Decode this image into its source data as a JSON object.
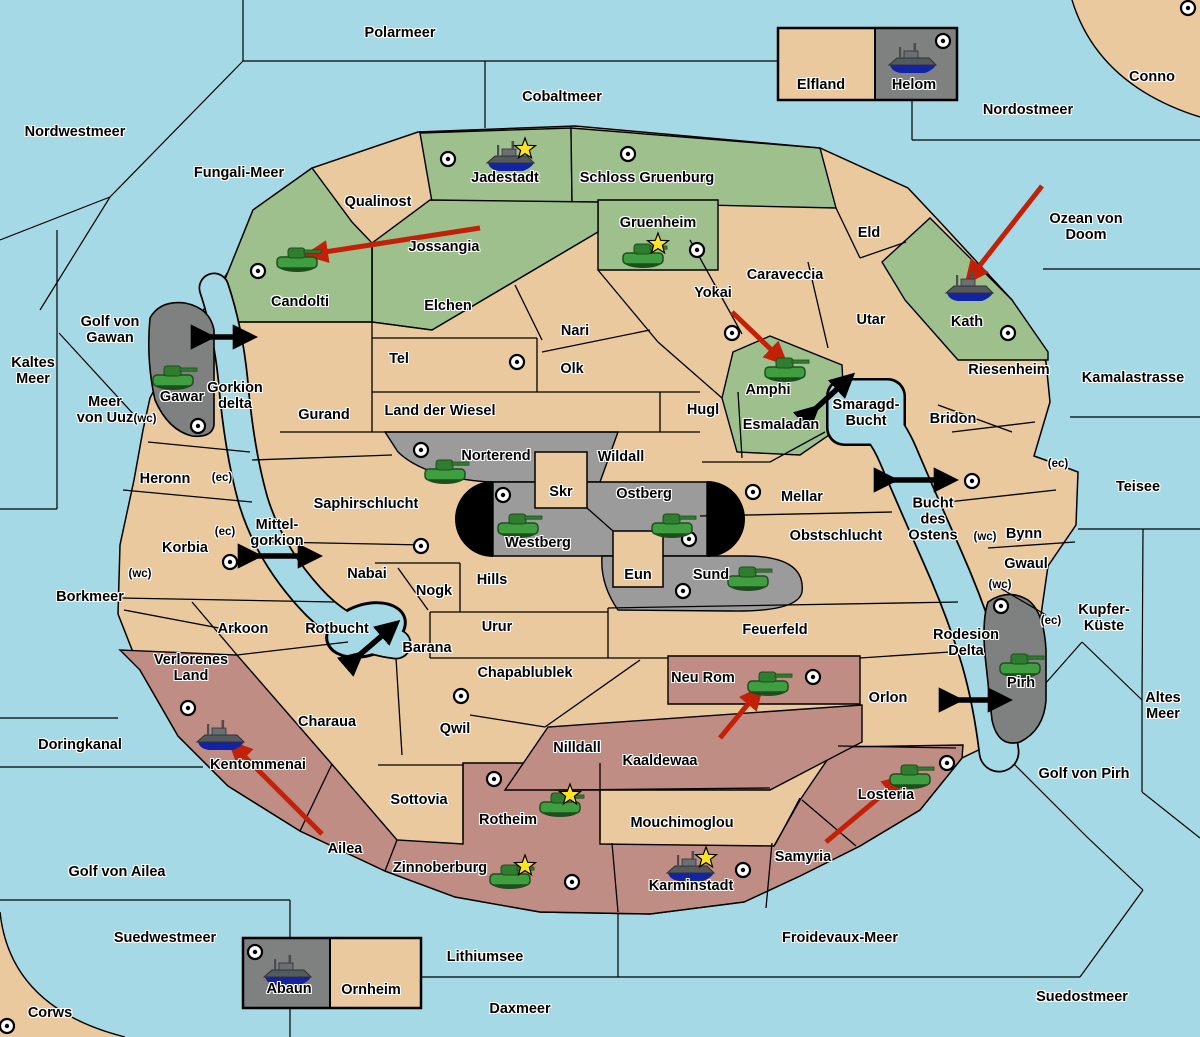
{
  "map": {
    "width": 1200,
    "height": 1037,
    "colors": {
      "sea": "#A6D9E6",
      "land": "#E9C99D",
      "green_faction": "#9DC08D",
      "red_faction": "#C08D85",
      "gray_light": "#9B9B9B",
      "gray_dark": "#7F8080",
      "black_feature": "#000000",
      "move_arrow": "#C22107",
      "strait_arrow": "#000000",
      "tank": "#3F9E3F",
      "ship": "#555A5E",
      "star": "#FFE41F",
      "border": "#000000"
    },
    "sea_zones": [
      {
        "name": "Polarmeer",
        "x": 400,
        "y": 33
      },
      {
        "name": "Nordwestmeer",
        "x": 75,
        "y": 132
      },
      {
        "name": "Fungali-Meer",
        "x": 239,
        "y": 173
      },
      {
        "name": "Cobaltmeer",
        "x": 562,
        "y": 97
      },
      {
        "name": "Nordostmeer",
        "x": 1028,
        "y": 110
      },
      {
        "name": "Ozean von Doom",
        "x": 1086,
        "y": 227
      },
      {
        "name": "Kaltes\nMeer",
        "x": 33,
        "y": 371
      },
      {
        "name": "Golf von\nGawan",
        "x": 110,
        "y": 330
      },
      {
        "name": "Meer\nvon Uuz",
        "x": 105,
        "y": 410
      },
      {
        "name": "Kamalastrasse",
        "x": 1133,
        "y": 378
      },
      {
        "name": "Teisee",
        "x": 1138,
        "y": 487
      },
      {
        "name": "Borkmeer",
        "x": 90,
        "y": 597
      },
      {
        "name": "Kupfer-\nKüste",
        "x": 1104,
        "y": 618
      },
      {
        "name": "Altes\nMeer",
        "x": 1163,
        "y": 706
      },
      {
        "name": "Doringkanal",
        "x": 80,
        "y": 745
      },
      {
        "name": "Golf von Pirh",
        "x": 1084,
        "y": 774
      },
      {
        "name": "Golf von Ailea",
        "x": 117,
        "y": 872
      },
      {
        "name": "Suedwestmeer",
        "x": 165,
        "y": 938
      },
      {
        "name": "Froidevaux-Meer",
        "x": 840,
        "y": 938
      },
      {
        "name": "Lithiumsee",
        "x": 485,
        "y": 957
      },
      {
        "name": "Daxmeer",
        "x": 520,
        "y": 1009
      },
      {
        "name": "Suedostmeer",
        "x": 1082,
        "y": 997
      },
      {
        "name": "Gorkion\ndelta",
        "x": 235,
        "y": 396
      },
      {
        "name": "Mittel-\ngorkion",
        "x": 277,
        "y": 533
      },
      {
        "name": "Rotbucht",
        "x": 337,
        "y": 629
      },
      {
        "name": "Smaragd-\nBucht",
        "x": 866,
        "y": 413
      },
      {
        "name": "Bucht\ndes\nOstens",
        "x": 933,
        "y": 520
      },
      {
        "name": "Rodesion\nDelta",
        "x": 966,
        "y": 643
      }
    ],
    "territories": [
      {
        "name": "Qualinost",
        "x": 378,
        "y": 202
      },
      {
        "name": "Jossangia",
        "x": 444,
        "y": 247
      },
      {
        "name": "Candolti",
        "x": 300,
        "y": 302
      },
      {
        "name": "Jadestadt",
        "x": 505,
        "y": 178
      },
      {
        "name": "Schloss Gruenburg",
        "x": 647,
        "y": 178
      },
      {
        "name": "Gruenheim",
        "x": 658,
        "y": 223
      },
      {
        "name": "Elfland",
        "x": 821,
        "y": 85
      },
      {
        "name": "Helom",
        "x": 914,
        "y": 85
      },
      {
        "name": "Conno",
        "x": 1152,
        "y": 77
      },
      {
        "name": "Eld",
        "x": 869,
        "y": 233
      },
      {
        "name": "Caraveccia",
        "x": 785,
        "y": 275
      },
      {
        "name": "Yokai",
        "x": 713,
        "y": 293
      },
      {
        "name": "Utar",
        "x": 871,
        "y": 320
      },
      {
        "name": "Kath",
        "x": 967,
        "y": 322
      },
      {
        "name": "Riesenheim",
        "x": 1009,
        "y": 370
      },
      {
        "name": "Bridon",
        "x": 953,
        "y": 419
      },
      {
        "name": "Elchen",
        "x": 448,
        "y": 306
      },
      {
        "name": "Nari",
        "x": 575,
        "y": 331
      },
      {
        "name": "Tel",
        "x": 399,
        "y": 359
      },
      {
        "name": "Olk",
        "x": 572,
        "y": 369
      },
      {
        "name": "Gurand",
        "x": 324,
        "y": 415
      },
      {
        "name": "Land der Wiesel",
        "x": 440,
        "y": 411
      },
      {
        "name": "Hugl",
        "x": 703,
        "y": 410
      },
      {
        "name": "Esmaladan",
        "x": 781,
        "y": 425
      },
      {
        "name": "Amphi",
        "x": 768,
        "y": 390
      },
      {
        "name": "Gawar",
        "x": 182,
        "y": 397
      },
      {
        "name": "Norterend",
        "x": 496,
        "y": 456
      },
      {
        "name": "Wildall",
        "x": 621,
        "y": 457
      },
      {
        "name": "Skr",
        "x": 561,
        "y": 492
      },
      {
        "name": "Ostberg",
        "x": 644,
        "y": 494
      },
      {
        "name": "Westberg",
        "x": 538,
        "y": 543
      },
      {
        "name": "Mellar",
        "x": 802,
        "y": 497
      },
      {
        "name": "Obstschlucht",
        "x": 836,
        "y": 536
      },
      {
        "name": "Bynn",
        "x": 1024,
        "y": 534
      },
      {
        "name": "Gwaul",
        "x": 1026,
        "y": 564
      },
      {
        "name": "Saphirschlucht",
        "x": 366,
        "y": 504
      },
      {
        "name": "Heronn",
        "x": 165,
        "y": 479
      },
      {
        "name": "Korbia",
        "x": 185,
        "y": 548
      },
      {
        "name": "Nabai",
        "x": 367,
        "y": 574
      },
      {
        "name": "Nogk",
        "x": 434,
        "y": 591
      },
      {
        "name": "Hills",
        "x": 492,
        "y": 580
      },
      {
        "name": "Eun",
        "x": 638,
        "y": 575
      },
      {
        "name": "Sund",
        "x": 711,
        "y": 575
      },
      {
        "name": "Urur",
        "x": 497,
        "y": 627
      },
      {
        "name": "Arkoon",
        "x": 243,
        "y": 629
      },
      {
        "name": "Barana",
        "x": 427,
        "y": 648
      },
      {
        "name": "Feuerfeld",
        "x": 775,
        "y": 630
      },
      {
        "name": "Verlorenes\nLand",
        "x": 191,
        "y": 668
      },
      {
        "name": "Chapablublek",
        "x": 525,
        "y": 673
      },
      {
        "name": "Neu Rom",
        "x": 703,
        "y": 678
      },
      {
        "name": "Orlon",
        "x": 888,
        "y": 698
      },
      {
        "name": "Pirh",
        "x": 1021,
        "y": 683
      },
      {
        "name": "Charaua",
        "x": 327,
        "y": 722
      },
      {
        "name": "Qwil",
        "x": 455,
        "y": 729
      },
      {
        "name": "Nilldall",
        "x": 577,
        "y": 748
      },
      {
        "name": "Kaaldewaa",
        "x": 660,
        "y": 761
      },
      {
        "name": "Kentommenai",
        "x": 258,
        "y": 765
      },
      {
        "name": "Losteria",
        "x": 886,
        "y": 795
      },
      {
        "name": "Sottovia",
        "x": 419,
        "y": 800
      },
      {
        "name": "Rotheim",
        "x": 508,
        "y": 820
      },
      {
        "name": "Mouchimoglou",
        "x": 682,
        "y": 823
      },
      {
        "name": "Ailea",
        "x": 345,
        "y": 849
      },
      {
        "name": "Samyria",
        "x": 803,
        "y": 857
      },
      {
        "name": "Zinnoberburg",
        "x": 440,
        "y": 868
      },
      {
        "name": "Karminstadt",
        "x": 691,
        "y": 886
      },
      {
        "name": "Abaun",
        "x": 289,
        "y": 989
      },
      {
        "name": "Ornheim",
        "x": 371,
        "y": 990
      },
      {
        "name": "Corws",
        "x": 50,
        "y": 1013
      }
    ],
    "coast_markers": [
      {
        "text": "(wc)",
        "x": 145,
        "y": 419
      },
      {
        "text": "(wc)",
        "x": 140,
        "y": 574
      },
      {
        "text": "(wc)",
        "x": 985,
        "y": 537
      },
      {
        "text": "(wc)",
        "x": 1000,
        "y": 585
      },
      {
        "text": "(ec)",
        "x": 222,
        "y": 478
      },
      {
        "text": "(ec)",
        "x": 225,
        "y": 532
      },
      {
        "text": "(ec)",
        "x": 1058,
        "y": 464
      },
      {
        "text": "(ec)",
        "x": 1051,
        "y": 621
      }
    ],
    "city_dots": [
      {
        "x": 448,
        "y": 159
      },
      {
        "x": 628,
        "y": 154
      },
      {
        "x": 943,
        "y": 41
      },
      {
        "x": 1188,
        "y": 8
      },
      {
        "x": 258,
        "y": 271
      },
      {
        "x": 697,
        "y": 250
      },
      {
        "x": 732,
        "y": 333
      },
      {
        "x": 517,
        "y": 362
      },
      {
        "x": 1008,
        "y": 333
      },
      {
        "x": 198,
        "y": 426
      },
      {
        "x": 421,
        "y": 450
      },
      {
        "x": 503,
        "y": 495
      },
      {
        "x": 689,
        "y": 539
      },
      {
        "x": 683,
        "y": 591
      },
      {
        "x": 753,
        "y": 492
      },
      {
        "x": 972,
        "y": 481
      },
      {
        "x": 1001,
        "y": 606
      },
      {
        "x": 421,
        "y": 546
      },
      {
        "x": 230,
        "y": 562
      },
      {
        "x": 188,
        "y": 708
      },
      {
        "x": 461,
        "y": 696
      },
      {
        "x": 813,
        "y": 677
      },
      {
        "x": 494,
        "y": 779
      },
      {
        "x": 572,
        "y": 882
      },
      {
        "x": 743,
        "y": 870
      },
      {
        "x": 947,
        "y": 763
      },
      {
        "x": 255,
        "y": 952
      },
      {
        "x": 7,
        "y": 1026
      }
    ],
    "units": [
      {
        "type": "tank",
        "territory": "Candolti",
        "x": 297,
        "y": 258
      },
      {
        "type": "tank",
        "territory": "Gruenheim",
        "x": 643,
        "y": 254
      },
      {
        "type": "tank",
        "territory": "Amphi",
        "x": 785,
        "y": 368
      },
      {
        "type": "tank",
        "territory": "Gawar",
        "x": 173,
        "y": 376
      },
      {
        "type": "tank",
        "territory": "Norterend",
        "x": 445,
        "y": 470
      },
      {
        "type": "tank",
        "territory": "Westberg",
        "x": 518,
        "y": 524
      },
      {
        "type": "tank",
        "territory": "Ostberg",
        "x": 672,
        "y": 524
      },
      {
        "type": "tank",
        "territory": "Sund",
        "x": 748,
        "y": 577
      },
      {
        "type": "tank",
        "territory": "Neu Rom",
        "x": 768,
        "y": 682
      },
      {
        "type": "tank",
        "territory": "Rotheim",
        "x": 560,
        "y": 803
      },
      {
        "type": "tank",
        "territory": "Zinnoberburg",
        "x": 510,
        "y": 875
      },
      {
        "type": "tank",
        "territory": "Losteria",
        "x": 910,
        "y": 775
      },
      {
        "type": "tank",
        "territory": "Pirh",
        "x": 1020,
        "y": 664
      },
      {
        "type": "ship",
        "territory": "Jadestadt",
        "x": 510,
        "y": 158
      },
      {
        "type": "ship",
        "territory": "Helom",
        "x": 912,
        "y": 60
      },
      {
        "type": "ship",
        "territory": "Kath",
        "x": 969,
        "y": 288
      },
      {
        "type": "ship",
        "territory": "Kentommenai",
        "x": 220,
        "y": 737
      },
      {
        "type": "ship",
        "territory": "Karminstadt",
        "x": 690,
        "y": 868
      },
      {
        "type": "ship",
        "territory": "Abaun",
        "x": 287,
        "y": 972
      }
    ],
    "victory_stars": [
      {
        "x": 525,
        "y": 149
      },
      {
        "x": 658,
        "y": 244
      },
      {
        "x": 570,
        "y": 795
      },
      {
        "x": 525,
        "y": 866
      },
      {
        "x": 706,
        "y": 858
      }
    ],
    "move_arrows": [
      {
        "from": "Jossangia",
        "to": "Candolti",
        "x1": 480,
        "y1": 228,
        "x2": 312,
        "y2": 254
      },
      {
        "from": "Yokai",
        "to": "Amphi",
        "x1": 732,
        "y1": 312,
        "x2": 782,
        "y2": 360
      },
      {
        "from": "Ozean von Doom",
        "to": "Kath",
        "x1": 1042,
        "y1": 186,
        "x2": 970,
        "y2": 278
      },
      {
        "from": "Kaaldewaa",
        "to": "Neu Rom",
        "x1": 720,
        "y1": 738,
        "x2": 758,
        "y2": 692
      },
      {
        "from": "Samyria",
        "to": "Losteria",
        "x1": 826,
        "y1": 842,
        "x2": 900,
        "y2": 780
      },
      {
        "from": "Ailea",
        "to": "Kentommenai",
        "x1": 322,
        "y1": 834,
        "x2": 234,
        "y2": 746
      }
    ],
    "strait_arrows": [
      {
        "name": "gorkion-delta",
        "x1": 205,
        "y1": 337,
        "x2": 247,
        "y2": 337
      },
      {
        "name": "mittel-gorkion",
        "x1": 252,
        "y1": 556,
        "x2": 312,
        "y2": 556
      },
      {
        "name": "rotbucht",
        "x1": 356,
        "y1": 658,
        "x2": 392,
        "y2": 627
      },
      {
        "name": "smaragd-bucht",
        "x1": 812,
        "y1": 412,
        "x2": 847,
        "y2": 380
      },
      {
        "name": "bucht-des-ostens",
        "x1": 888,
        "y1": 480,
        "x2": 948,
        "y2": 480
      },
      {
        "name": "rodesion-delta",
        "x1": 953,
        "y1": 700,
        "x2": 1002,
        "y2": 700
      }
    ]
  }
}
